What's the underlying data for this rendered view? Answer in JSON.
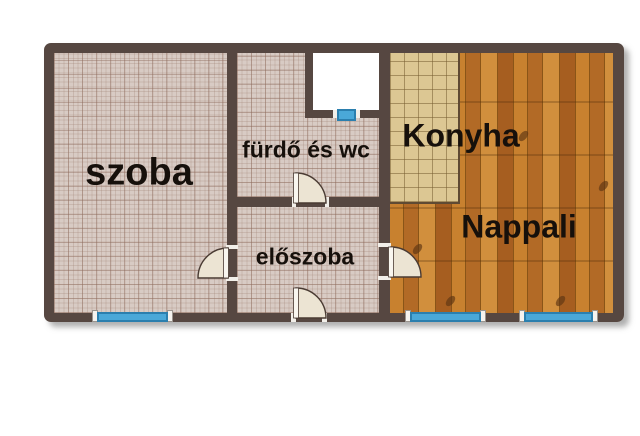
{
  "plan": {
    "type": "apartment-floor-plan",
    "rooms": [
      {
        "id": "szoba",
        "label": "szoba"
      },
      {
        "id": "furdo",
        "label": "fürdő és wc"
      },
      {
        "id": "eloszoba",
        "label": "előszoba"
      },
      {
        "id": "konyha",
        "label": "Konyha"
      },
      {
        "id": "nappali",
        "label": "Nappali"
      }
    ],
    "features": {
      "windows": 4,
      "doors": 4,
      "light_well": 1
    },
    "colors": {
      "wall": "#564741",
      "window_blue": "#4aa8d8",
      "window_border": "#2b7fae",
      "tile_pink": "#d8cbc4",
      "tile_tan": "#dcc793",
      "wood": "#bf7a2e",
      "door_fill": "#ece4d3",
      "label_text": "#16100b",
      "background": "#ffffff"
    }
  }
}
